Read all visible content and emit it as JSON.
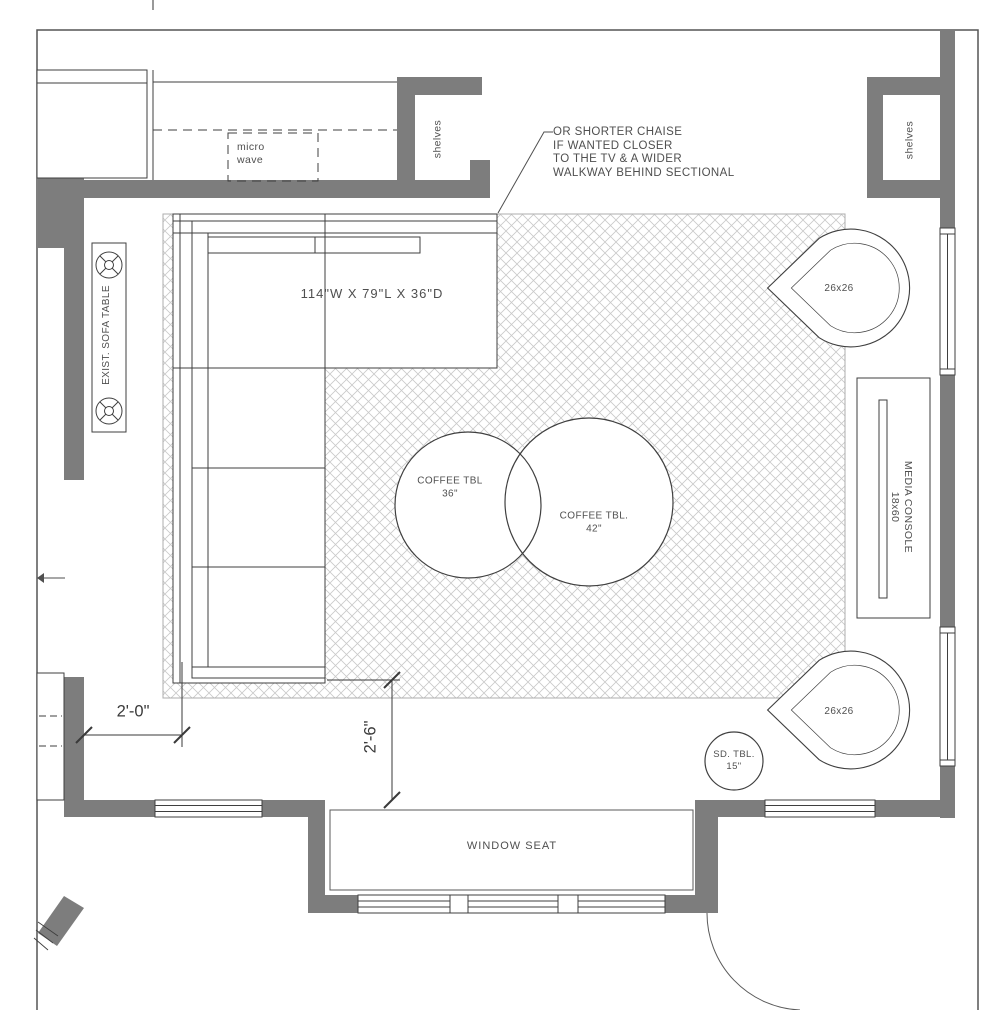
{
  "drawing": {
    "note": {
      "line1": "OR SHORTER CHAISE",
      "line2": "IF WANTED CLOSER",
      "line3": "TO THE TV & A WIDER",
      "line4": "WALKWAY BEHIND SECTIONAL"
    },
    "kitchen": {
      "microwave_line1": "micro",
      "microwave_line2": "wave",
      "shelves_label": "shelves"
    },
    "living": {
      "sectional_size": "114\"W X 79\"L X 36\"D",
      "sofa_table": "EXIST. SOFA TABLE",
      "coffee_table_small": {
        "label": "COFFEE TBL",
        "size": "36\""
      },
      "coffee_table_large": {
        "label": "COFFEE TBL.",
        "size": "42\""
      },
      "corner_chair_top": "26x26",
      "corner_chair_bottom": "26x26",
      "side_table": {
        "label": "SD. TBL.",
        "size": "15\""
      },
      "media_console": {
        "label": "MEDIA CONSOLE",
        "size": "18x60"
      },
      "window_seat": "WINDOW SEAT",
      "shelves_label": "shelves"
    },
    "dimensions": {
      "walkway_left": "2'-0\"",
      "walkway_bottom": "2'-6\""
    },
    "colors": {
      "wall": "#7d7d7d",
      "line": "#3f3f3f",
      "hatch": "#c9c9c9",
      "text": "#4f4f4f"
    }
  }
}
